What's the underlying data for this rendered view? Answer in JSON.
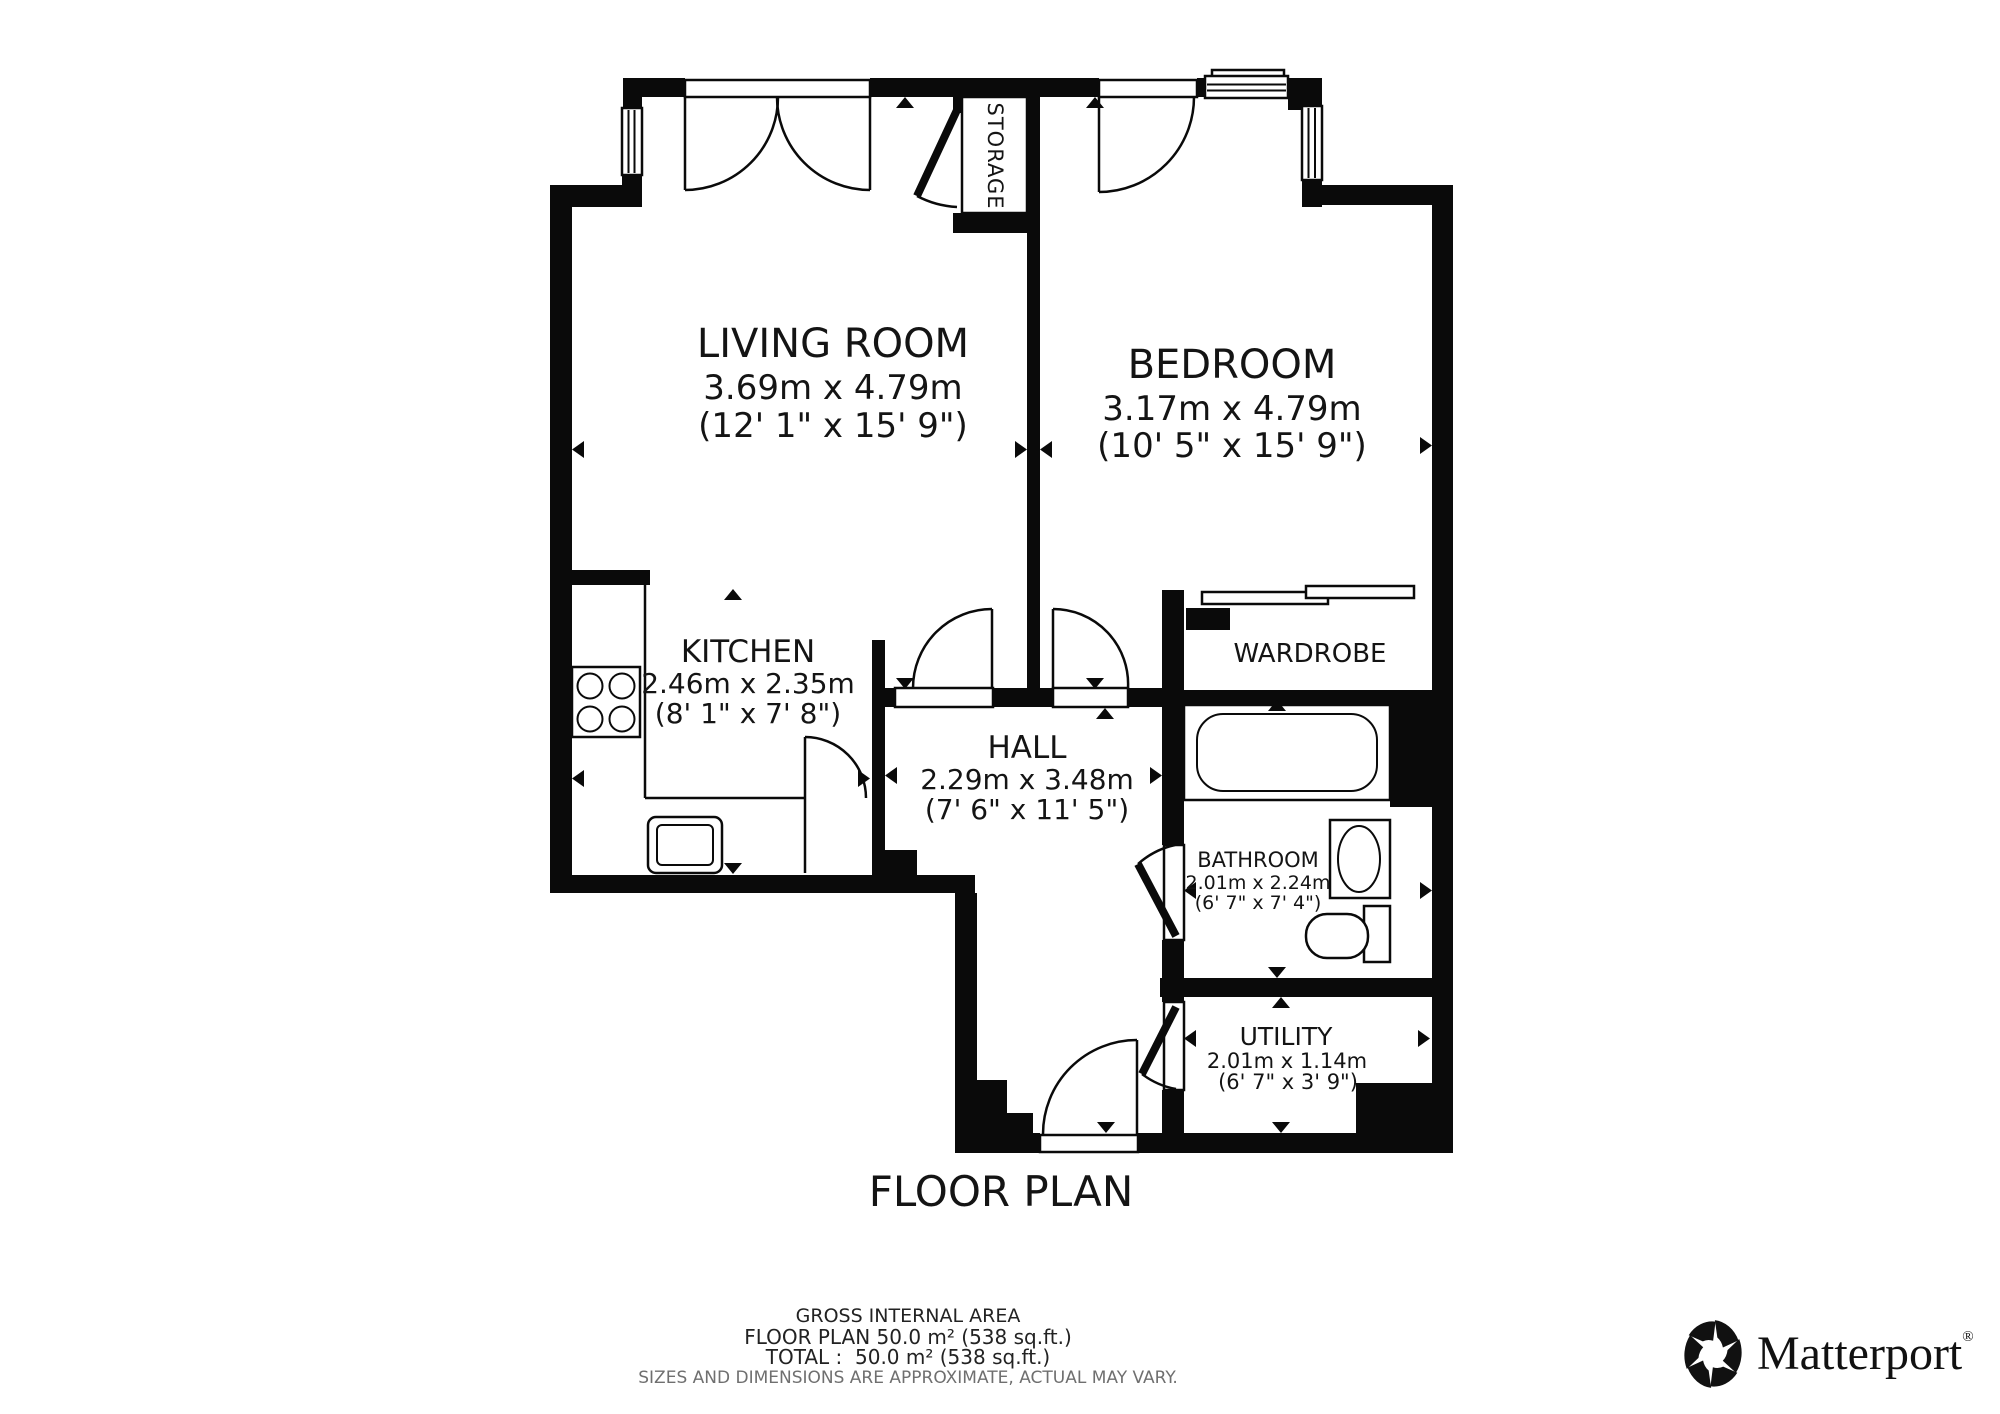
{
  "title": "FLOOR PLAN",
  "rooms": [
    {
      "id": "living-room",
      "name": "LIVING ROOM",
      "metric": "3.69m x 4.79m",
      "imperial": "(12' 1\" x 15' 9\")"
    },
    {
      "id": "bedroom",
      "name": "BEDROOM",
      "metric": "3.17m x 4.79m",
      "imperial": "(10' 5\" x 15' 9\")"
    },
    {
      "id": "kitchen",
      "name": "KITCHEN",
      "metric": "2.46m x 2.35m",
      "imperial": "(8' 1\" x 7' 8\")"
    },
    {
      "id": "hall",
      "name": "HALL",
      "metric": "2.29m x 3.48m",
      "imperial": "(7' 6\" x 11' 5\")"
    },
    {
      "id": "bathroom",
      "name": "BATHROOM",
      "metric": "2.01m x 2.24m",
      "imperial": "(6' 7\" x 7' 4\")"
    },
    {
      "id": "utility",
      "name": "UTILITY",
      "metric": "2.01m x 1.14m",
      "imperial": "(6' 7\" x 3' 9\")"
    },
    {
      "id": "wardrobe",
      "name": "WARDROBE"
    },
    {
      "id": "storage",
      "name": "STORAGE"
    }
  ],
  "footer": {
    "line1": "GROSS INTERNAL AREA",
    "line2": "FLOOR PLAN 50.0 m² (538 sq.ft.)",
    "line3": "TOTAL :  50.0 m² (538 sq.ft.)",
    "disclaimer": "SIZES AND DIMENSIONS ARE APPROXIMATE, ACTUAL MAY VARY."
  },
  "branding": {
    "logo_icon": "matterport-pinwheel-icon",
    "wordmark": "Matterport",
    "registered": "®"
  },
  "colors": {
    "walls": "#0a0a0a",
    "background": "#ffffff",
    "text": "#141414",
    "muted_text": "#6f6f6f"
  }
}
